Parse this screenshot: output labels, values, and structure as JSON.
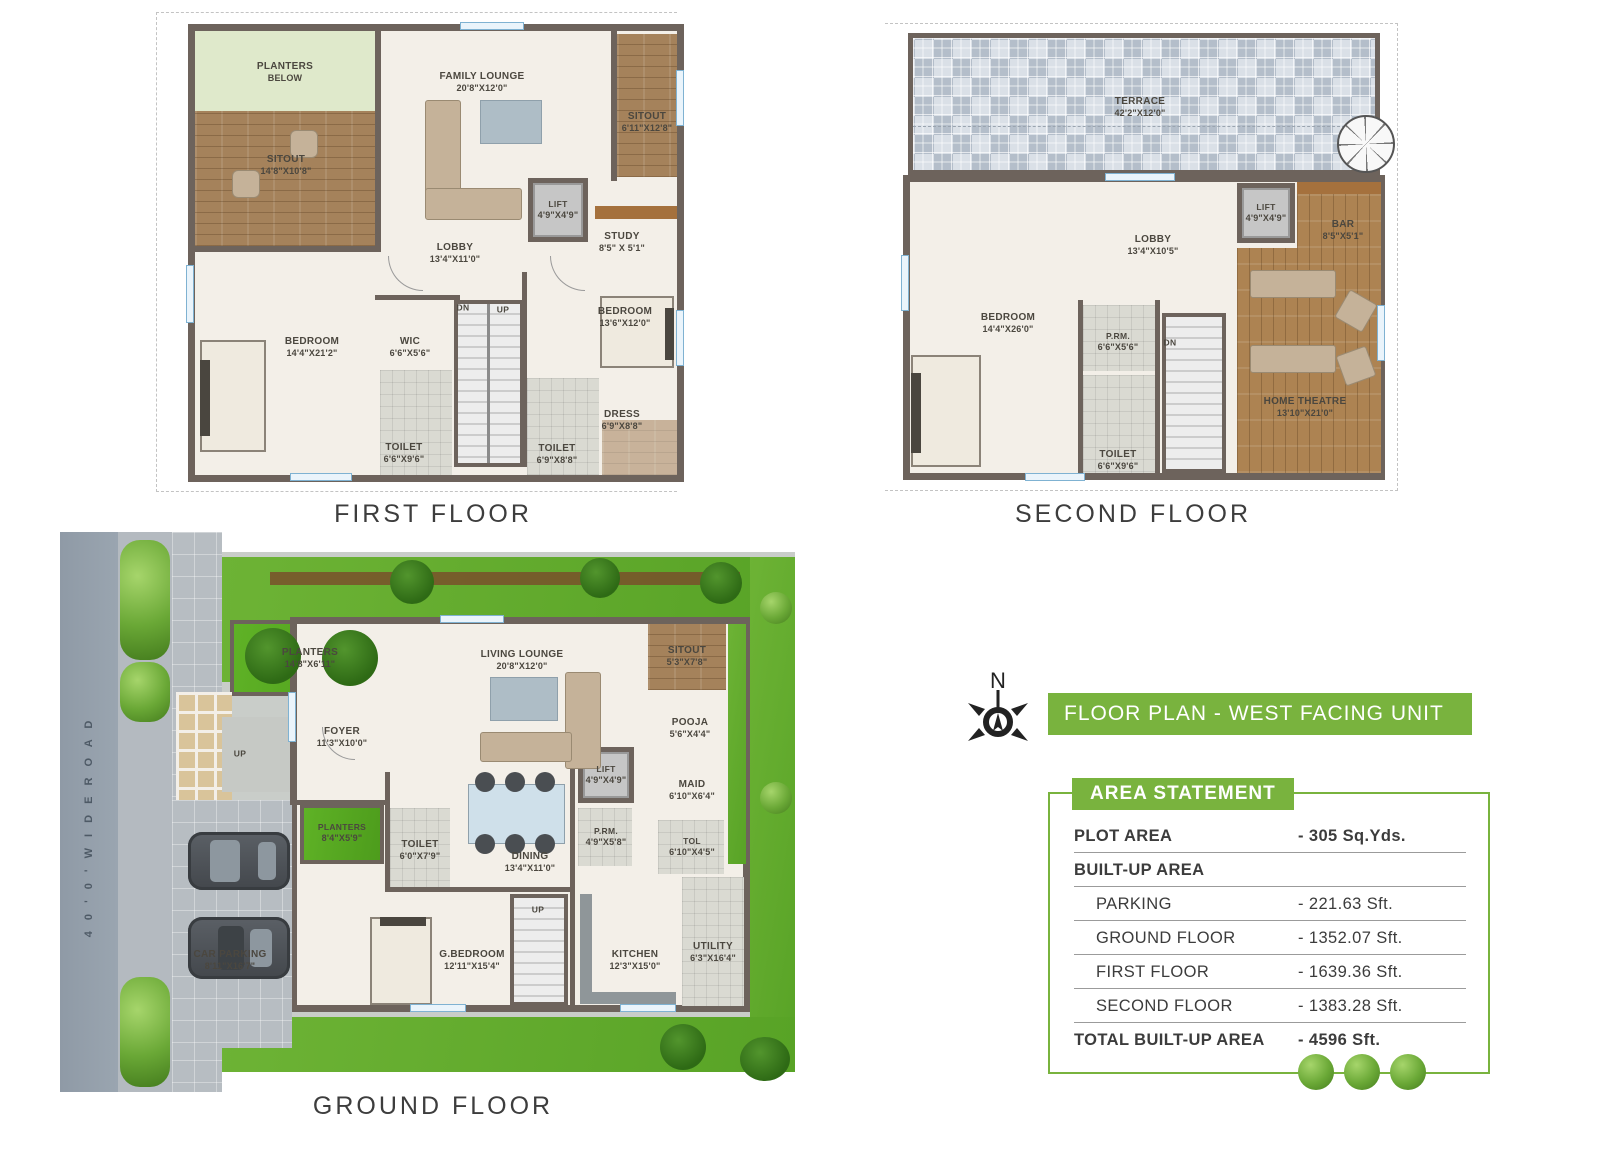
{
  "banner": {
    "text": "FLOOR PLAN - WEST FACING UNIT W1"
  },
  "compass": {
    "label": "N"
  },
  "road_label": "4 0 ' 0 '   W I D E   R O A D",
  "titles": {
    "first": "FIRST FLOOR",
    "second": "SECOND FLOOR",
    "ground": "GROUND FLOOR"
  },
  "colors": {
    "accent_green": "#79b33e",
    "wall": "#6d635c",
    "grass": "#64ad2f"
  },
  "plans": {
    "first": {
      "rooms": [
        {
          "n": "PLANTERS",
          "d": "BELOW"
        },
        {
          "n": "SITOUT",
          "d": "14'8\"X10'8\""
        },
        {
          "n": "FAMILY LOUNGE",
          "d": "20'8\"X12'0\""
        },
        {
          "n": "SITOUT",
          "d": "6'11\"X12'8\""
        },
        {
          "n": "LIFT",
          "d": "4'9\"X4'9\""
        },
        {
          "n": "STUDY",
          "d": "8'5\" X 5'1\""
        },
        {
          "n": "LOBBY",
          "d": "13'4\"X11'0\""
        },
        {
          "n": "BEDROOM",
          "d": "14'4\"X21'2\""
        },
        {
          "n": "WIC",
          "d": "6'6\"X5'6\""
        },
        {
          "n": "BEDROOM",
          "d": "13'6\"X12'0\""
        },
        {
          "n": "TOILET",
          "d": "6'6\"X9'6\""
        },
        {
          "n": "TOILET",
          "d": "6'9\"X8'8\""
        },
        {
          "n": "DRESS",
          "d": "6'9\"X8'8\""
        },
        {
          "n": "DN"
        },
        {
          "n": "UP"
        }
      ]
    },
    "second": {
      "rooms": [
        {
          "n": "TERRACE",
          "d": "42'2\"X12'0\""
        },
        {
          "n": "LIFT",
          "d": "4'9\"X4'9\""
        },
        {
          "n": "BAR",
          "d": "8'5\"X5'1\""
        },
        {
          "n": "LOBBY",
          "d": "13'4\"X10'5\""
        },
        {
          "n": "BEDROOM",
          "d": "14'4\"X26'0\""
        },
        {
          "n": "P.RM.",
          "d": "6'6\"X5'6\""
        },
        {
          "n": "TOILET",
          "d": "6'6\"X9'6\""
        },
        {
          "n": "HOME THEATRE",
          "d": "13'10\"X21'0\""
        },
        {
          "n": "DN"
        }
      ]
    },
    "ground": {
      "rooms": [
        {
          "n": "PLANTERS",
          "d": "14'8\"X6'11\""
        },
        {
          "n": "FOYER",
          "d": "11'3\"X10'0\""
        },
        {
          "n": "UP"
        },
        {
          "n": "LIVING LOUNGE",
          "d": "20'8\"X12'0\""
        },
        {
          "n": "SITOUT",
          "d": "5'3\"X7'8\""
        },
        {
          "n": "POOJA",
          "d": "5'6\"X4'4\""
        },
        {
          "n": "LIFT",
          "d": "4'9\"X4'9\""
        },
        {
          "n": "MAID",
          "d": "6'10\"X6'4\""
        },
        {
          "n": "P.RM.",
          "d": "4'9\"X5'8\""
        },
        {
          "n": "TOL",
          "d": "6'10\"X4'5\""
        },
        {
          "n": "DINING",
          "d": "13'4\"X11'0\""
        },
        {
          "n": "TOILET",
          "d": "6'0\"X7'9\""
        },
        {
          "n": "PLANTERS",
          "d": "8'4\"X5'9\""
        },
        {
          "n": "CAR PARKING",
          "d": "8'11\"X16'7\""
        },
        {
          "n": "G.BEDROOM",
          "d": "12'11\"X15'4\""
        },
        {
          "n": "KITCHEN",
          "d": "12'3\"X15'0\""
        },
        {
          "n": "UTILITY",
          "d": "6'3\"X16'4\""
        },
        {
          "n": "UP"
        }
      ]
    }
  },
  "area_statement": {
    "title": "AREA STATEMENT",
    "rows": [
      {
        "label": "PLOT AREA",
        "value": "- 305 Sq.Yds."
      },
      {
        "label": "BUILT-UP AREA",
        "value": ""
      },
      {
        "label": "PARKING",
        "value": "-   221.63 Sft."
      },
      {
        "label": "GROUND FLOOR",
        "value": "- 1352.07 Sft."
      },
      {
        "label": "FIRST FLOOR",
        "value": "- 1639.36 Sft."
      },
      {
        "label": "SECOND FLOOR",
        "value": "- 1383.28 Sft."
      },
      {
        "label": "TOTAL BUILT-UP AREA",
        "value": "- 4596 Sft."
      }
    ]
  }
}
